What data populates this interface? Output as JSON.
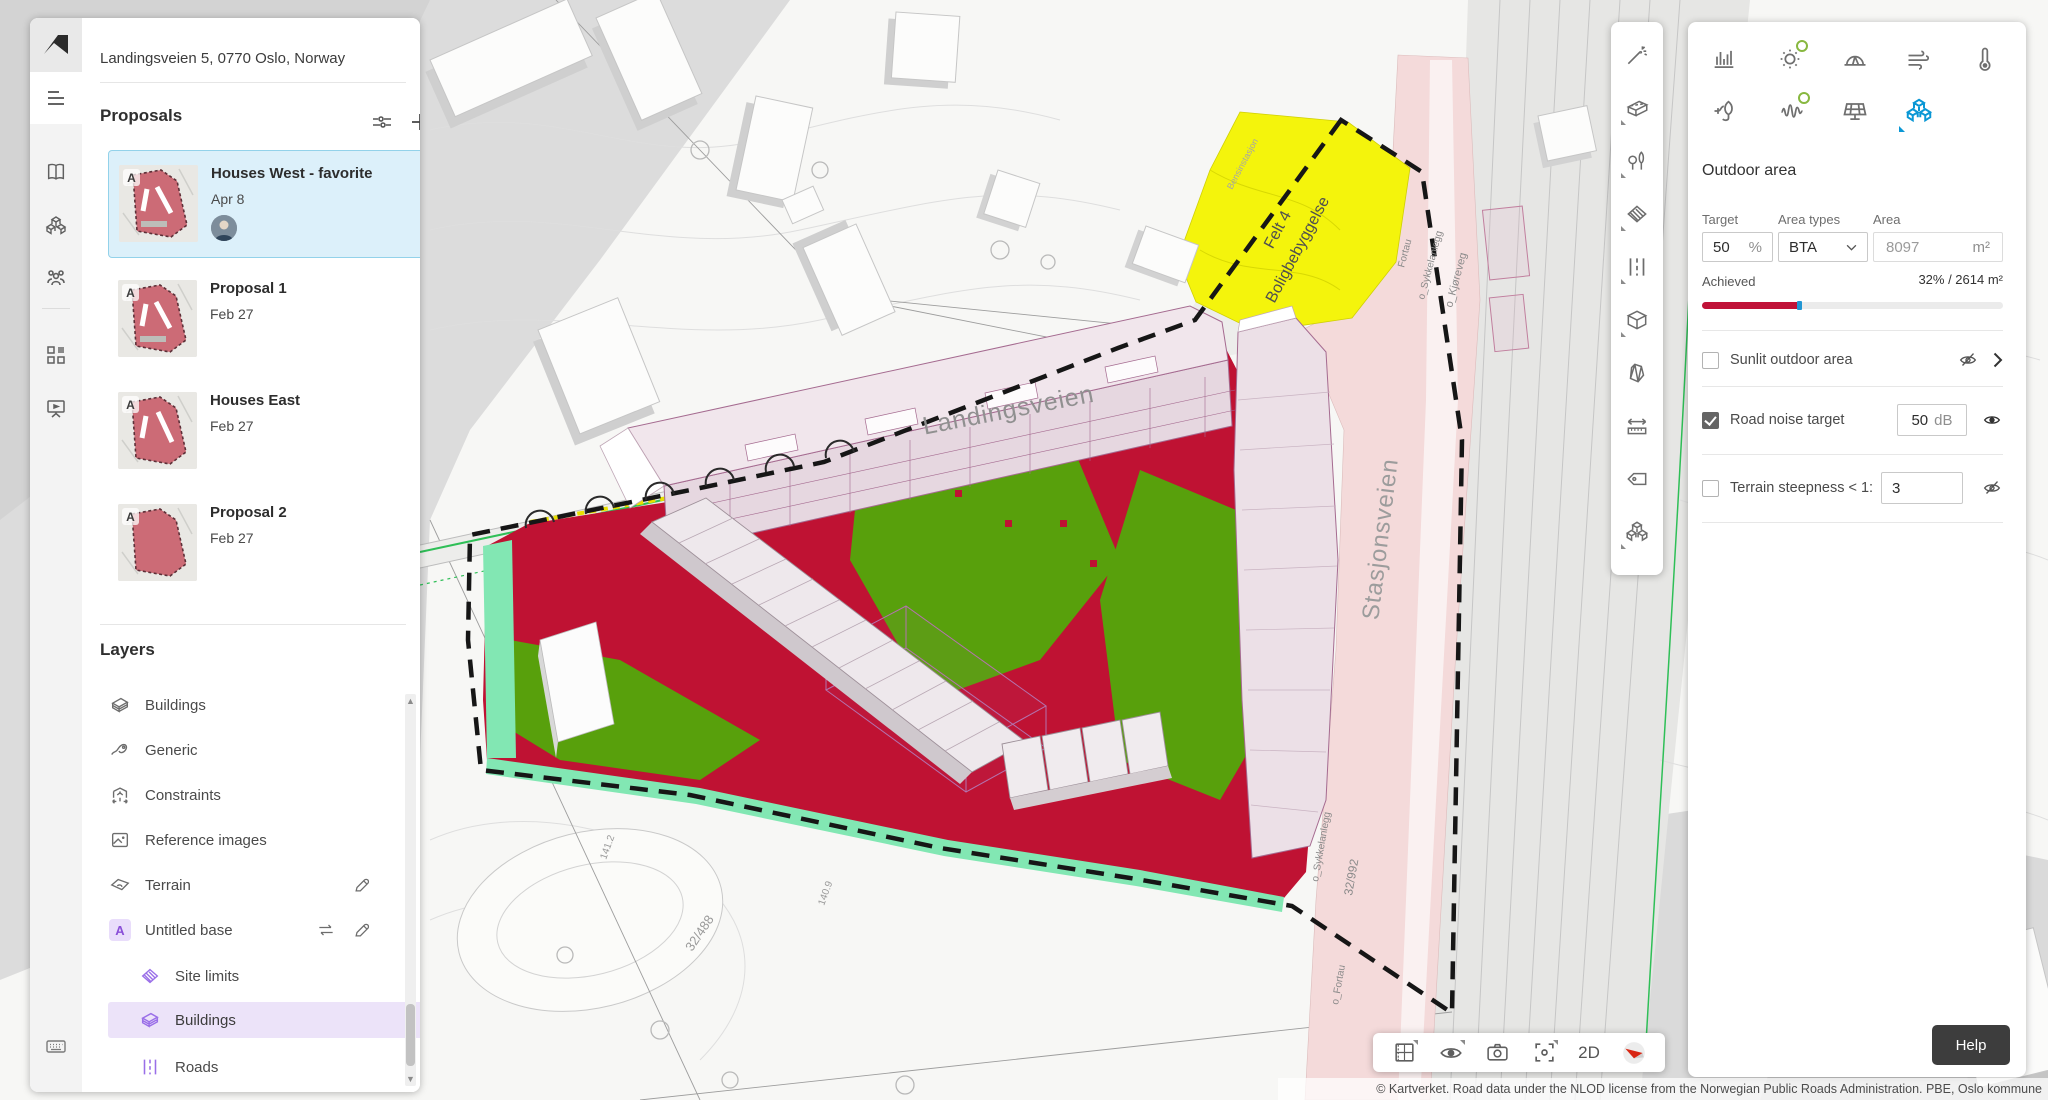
{
  "app": {
    "address": "Landingsveien 5, 0770 Oslo, Norway",
    "help_label": "Help",
    "copyright": "© Kartverket. Road data under the NLOD license from the Norwegian Public Roads Administration. PBE, Oslo kommune"
  },
  "left_rail": {
    "icons": [
      "autodesk-logo",
      "menu",
      "library-book",
      "blocks-3d",
      "people",
      "apps-grid",
      "presentation",
      "keyboard"
    ]
  },
  "proposals": {
    "title": "Proposals",
    "header_icons": [
      "filter-sliders",
      "add-plus"
    ],
    "items": [
      {
        "title": "Houses West - favorite",
        "date": "Apr 8",
        "badge": "A",
        "selected": true,
        "has_avatar": true
      },
      {
        "title": "Proposal 1",
        "date": "Feb 27",
        "badge": "A",
        "selected": false
      },
      {
        "title": "Houses East",
        "date": "Feb 27",
        "badge": "A",
        "selected": false
      },
      {
        "title": "Proposal 2",
        "date": "Feb 27",
        "badge": "A",
        "selected": false
      }
    ]
  },
  "layers": {
    "title": "Layers",
    "items": [
      {
        "label": "Buildings",
        "level": "top",
        "icon": "buildings-3d"
      },
      {
        "label": "Generic",
        "level": "top",
        "icon": "generic-scribble"
      },
      {
        "label": "Constraints",
        "level": "top",
        "icon": "constraints-box"
      },
      {
        "label": "Reference images",
        "level": "top",
        "icon": "image"
      },
      {
        "label": "Terrain",
        "level": "top",
        "icon": "terrain",
        "editable": true
      },
      {
        "label": "Untitled base",
        "level": "top",
        "badge": "A",
        "swappable": true,
        "editable": true
      },
      {
        "label": "Site limits",
        "level": "sub",
        "icon": "hatched-site"
      },
      {
        "label": "Buildings",
        "level": "sub",
        "icon": "buildings-3d",
        "highlighted": true
      },
      {
        "label": "Roads",
        "level": "sub",
        "icon": "road-dashes"
      }
    ]
  },
  "tool_rail": {
    "tools": [
      "magic-wand",
      "building-tool",
      "vegetation-tool",
      "zone-tool",
      "road-tool",
      "volume-box-tool",
      "prism-tool",
      "measure-tool",
      "label-tag-tool",
      "blocks-tool"
    ]
  },
  "right_panel": {
    "analysis_icons_row1": [
      "statistics-bars",
      "sun",
      "daylight-dome",
      "wind",
      "thermometer"
    ],
    "analysis_icons_row2": [
      "energy-plug-leaf",
      "noise-wave",
      "solar-panel",
      "area-cubes"
    ],
    "active_icon": "area-cubes",
    "title": "Outdoor area",
    "target": {
      "label": "Target",
      "value": "50",
      "unit": "%"
    },
    "area_types": {
      "label": "Area types",
      "value": "BTA"
    },
    "area": {
      "label": "Area",
      "value": "8097",
      "unit": "m²"
    },
    "achieved": {
      "label": "Achieved",
      "value": "32% / 2614 m²",
      "percent": 32
    },
    "rows": [
      {
        "label": "Sunlit outdoor area",
        "checked": false,
        "icons": [
          "eye-off",
          "chevron-right"
        ]
      },
      {
        "label": "Road noise target",
        "checked": true,
        "value": "50",
        "unit": "dB",
        "icons": [
          "eye"
        ]
      },
      {
        "label": "Terrain steepness < 1:",
        "checked": false,
        "value": "3",
        "icons": [
          "eye-off"
        ]
      }
    ]
  },
  "view_bar": {
    "icons": [
      "plan-grid",
      "visibility-eye",
      "camera",
      "focus-frame"
    ],
    "mode_label": "2D",
    "compass": "compass-north"
  },
  "map": {
    "labels": {
      "street1": "Landingsveien",
      "street2": "Stasjonsveien",
      "zone_line1": "Felt 4",
      "zone_line2": "Boligbebyggelse",
      "fortau": "Fortau",
      "sykkel1": "o_Sykkelanlegg",
      "kjoreveg": "o_Kjøreveg",
      "sykkel2": "o_Sykkelanlegg",
      "parcel1": "32/992",
      "fortau2": "o_Fortau",
      "parcel2": "32/488",
      "elev1": "141.2",
      "elev2": "140.9",
      "poi": "Bensinstasjon"
    },
    "colors": {
      "noise_red": "#bf1233",
      "quiet_green": "#58a00c",
      "buffer_mint": "#82e7b3",
      "zone_yellow": "#f4f40c",
      "road_pink": "#f4dada",
      "proposal_outline": "#a56b90",
      "accent_blue": "#0a97d5",
      "layer_purple": "#9a6fe8"
    }
  }
}
